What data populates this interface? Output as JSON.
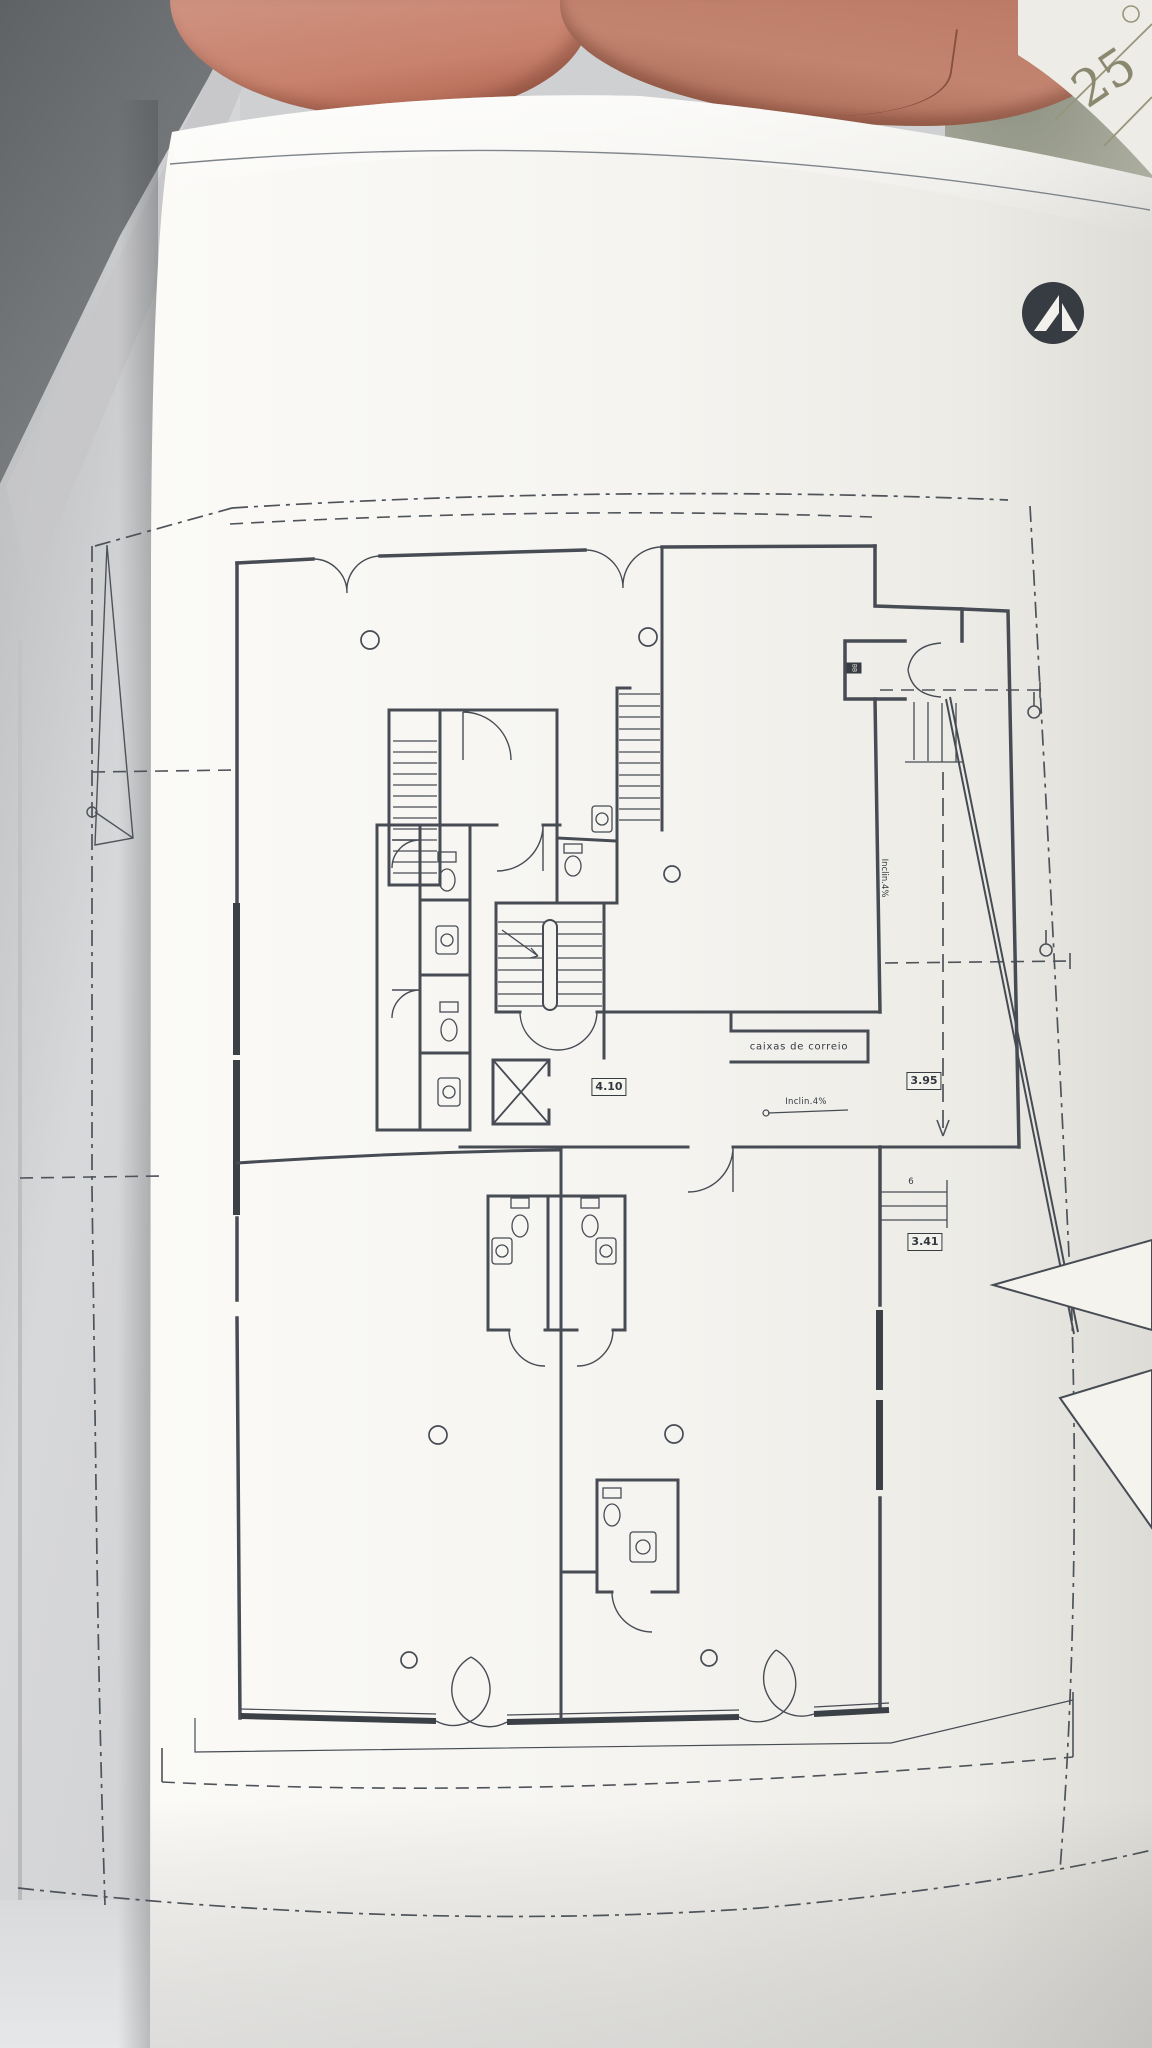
{
  "scene": {
    "environment": {
      "background_sheet": {
        "number": "25"
      },
      "window_frame": "window-frame",
      "leather_object": "leather-chair-back"
    },
    "logo": {
      "name": "architect-monogram-logo",
      "color": "#373c42"
    },
    "colors": {
      "paper": "#f5f4f0",
      "plan_line": "#474c54",
      "glazing": "#3b4046",
      "leather": "#c0765f",
      "frame_gray": "#7d8083"
    }
  },
  "plan": {
    "annotations": {
      "mailboxes_label": "caixas de correio",
      "slope_label": "Inclin.4%",
      "ramp_slope_label": "Inclin.4%",
      "entrance_tag": "BB",
      "exterior_steps_count": "6"
    },
    "dimensions": {
      "hall_width": "4.10",
      "walkway_upper": "3.95",
      "walkway_lower": "3.41"
    }
  }
}
